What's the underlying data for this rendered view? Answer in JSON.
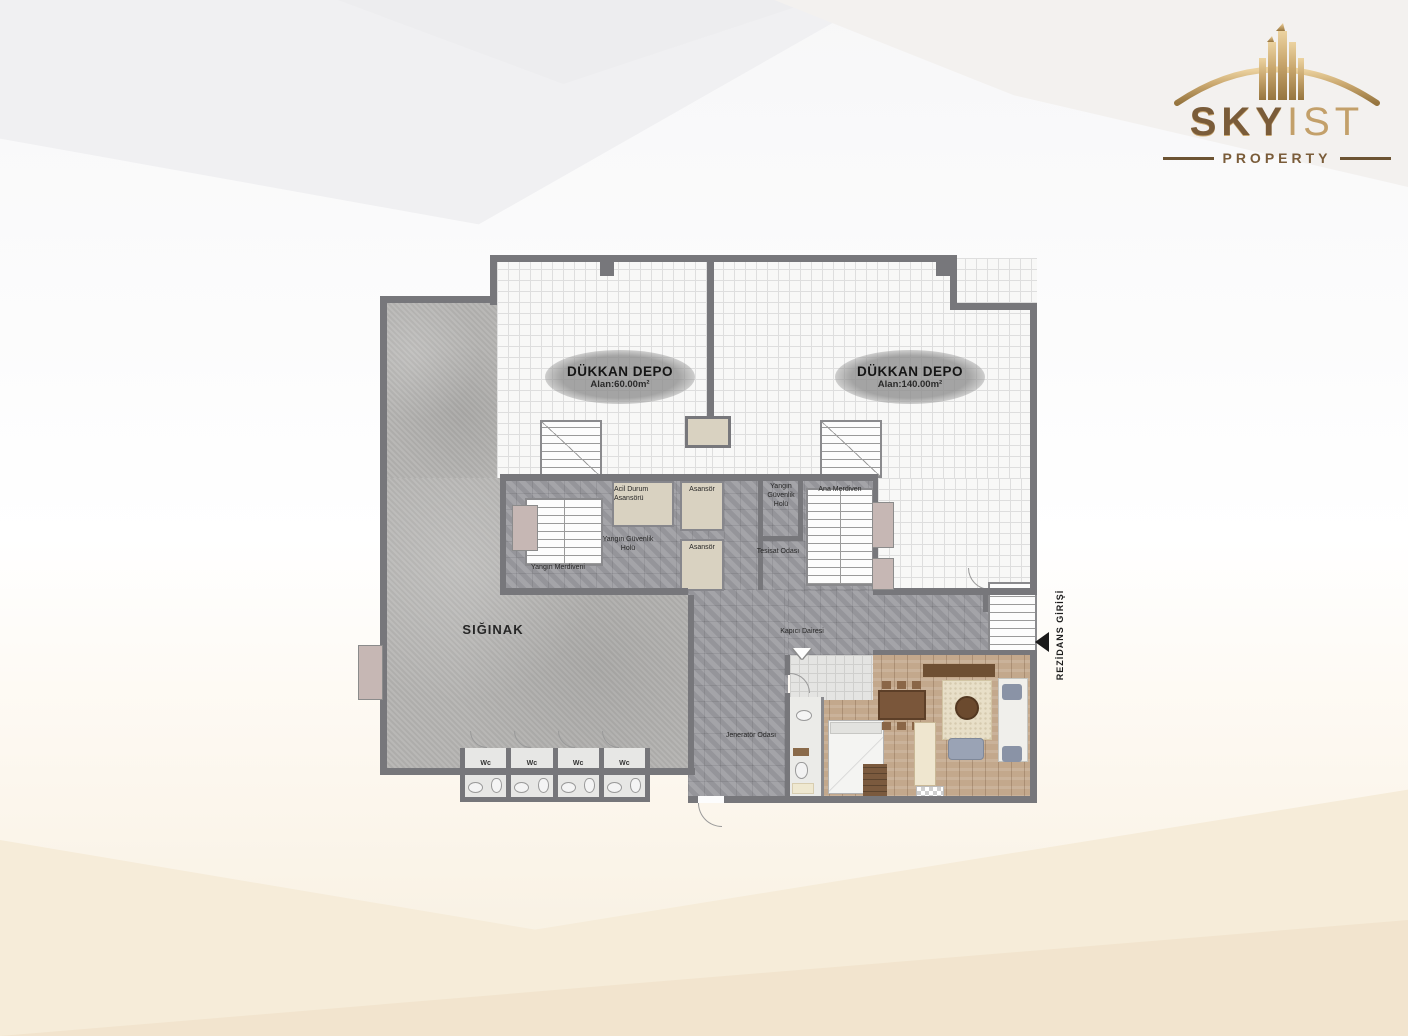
{
  "logo": {
    "brand_primary": "SKY",
    "brand_secondary": "IST",
    "tagline": "PROPERTY"
  },
  "shops": [
    {
      "name": "DÜKKAN DEPO",
      "area": "Alan:60.00m²"
    },
    {
      "name": "DÜKKAN DEPO",
      "area": "Alan:140.00m²"
    }
  ],
  "rooms": {
    "shelter": "SIĞINAK",
    "emergency_elevator": "Acil Durum Asansörü",
    "elevator_1": "Asansör",
    "elevator_2": "Asansör",
    "fire_security_hall_left": "Yangın Güvenlik Holü",
    "fire_security_hall_right": "Yangın Güvenlik Holü",
    "fire_stairs": "Yangın Merdiveni",
    "main_stairs": "Ana Merdiven",
    "utility_room": "Tesisat Odası",
    "caretaker_flat": "Kapıcı Dairesi",
    "generator_room": "Jeneratör Odası",
    "wc": [
      "Wc",
      "Wc",
      "Wc",
      "Wc"
    ]
  },
  "entrance": {
    "label": "REZİDANS GİRİŞİ"
  },
  "colors": {
    "logo_gold": "#c8a86e",
    "wall_gray": "#77777b",
    "concrete_gray": "#b5b4b2",
    "core_gray": "#9d9da2",
    "tile_white": "#f8f8f7",
    "wood_brown": "#c3a88c"
  }
}
